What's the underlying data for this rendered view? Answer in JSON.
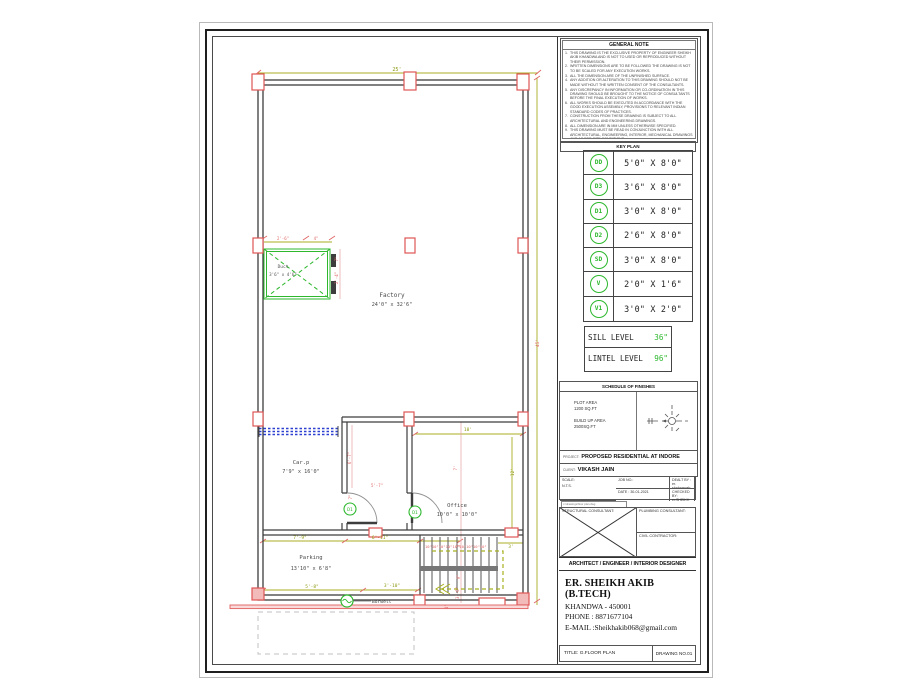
{
  "sheet": {
    "general_note": {
      "title": "GENERAL NOTE",
      "items": [
        "THIS DRAWING IS THE EXCLUSIVE PROPERTY OF ENGINEER SHEIKH AKIB KHANDWA AND IS NOT TO USED OR REPRODUCED WITHOUT THEIR PERMISSION.",
        "WRITTEN DIMENSIONS ARE TO BE FOLLOWED THE DRAWING IS NOT TO BE SCALED FOR ANY EXECUTION WORKS.",
        "ALL THE DIMENSION ARE OF THE UNFINISHED SURFACE.",
        "ANY ADDITION OR ALTERATION TO THIS DRAWING SHOULD NOT BE MADE WITHOUT THE WRITTEN CONSENT OF THE CONSULTANTS.",
        "ANY DISCREPANCY IN INFORMATION OR CO-ORDINATION IN THIS DRAWING SHOULD BE BROUGHT TO THE NOTICE OF CONSULTANTS BEFORE THE FINAL EXECUTION OF WORKS.",
        "ALL WORKS SHOULD BE EXECUTED IN ACCORDANCE WITH THE GOOD EXECUTION ASSEMBLY, PROVISIONS TO RELEVANT INDIAN STANDARD CODES OF PRACTICES.",
        "CONSTRUCTION FROM THESE DRAWING IS SUBJECT TO ALL ARCHITECTURAL AND ENGINEERING DRAWINGS.",
        "ALL DIMENSION ARE IN MM UNLESS OTHERWISE SPECIFIED.",
        "THIS DRAWING MUST BE READ IN CONJUNCTION WITH ALL ARCHITECTURAL, ENGINEERING, INTERIOR, MECHANICAL DRAWINGS AND AS PER SITE CONDITIONS."
      ]
    },
    "key_plan": {
      "title": "KEY PLAN",
      "rows": [
        {
          "code": "DD",
          "size": "5'0\" X 8'0\""
        },
        {
          "code": "D3",
          "size": "3'6\" X 8'0\""
        },
        {
          "code": "D1",
          "size": "3'0\" X 8'0\""
        },
        {
          "code": "D2",
          "size": "2'6\" X 8'0\""
        },
        {
          "code": "SD",
          "size": "3'0\" X 8'0\""
        },
        {
          "code": "V",
          "size": "2'0\" X 1'6\""
        },
        {
          "code": "V1",
          "size": "3'0\" X 2'0\""
        }
      ]
    },
    "levels": {
      "sill_label": "SILL LEVEL",
      "sill_value": "36\"",
      "lintel_label": "LINTEL LEVEL",
      "lintel_value": "96\""
    },
    "finishes": {
      "title": "SCHEDULE OF FINISHES",
      "plot_area_label": "PLOT AREA",
      "plot_area_value": "1200 SQ.FT",
      "builtup_label": "BUILD UP AREA",
      "builtup_value": "2500SQ.FT"
    },
    "project": {
      "label": "PROJECT:",
      "value": "PROPOSED RESIDENTIAL AT INDORE"
    },
    "client": {
      "label": "CLIENT:",
      "value": "VIKASH JAIN"
    },
    "meta": {
      "job_no": "JOB NO.:",
      "dealt_by": "DEALT BY : er. shahnawab",
      "scale_label": "SCALE:",
      "scale_value": "N.T.S.",
      "date": "DATE :   30-01-2021",
      "checked_by": "CHECKED BY: er.SHEIKH AKIB",
      "file_path_note": "c:\\drawings\\floor plan.dwg"
    },
    "consultants": {
      "structural": "STRUCTURAL CONSULTANT:",
      "plumbing": "PLUMBING CONSULTANT:",
      "civil": "CIVIL CONTRACTOR:"
    },
    "designer_bar": "ARCHITECT / ENGINEER / INTERIOR DESIGNER",
    "contact": {
      "name": "ER. SHEIKH AKIB (B.TECH)",
      "address": "KHANDWA - 450001",
      "phone": "PHONE : 8871677104",
      "email": "E-MAIL :Sheikhakib068@gmail.com"
    },
    "title_bar": {
      "title": "TITLE: G.FLOOR PLAN",
      "drawing_no": "DRAWING NO.01"
    }
  },
  "plan": {
    "rooms": {
      "factory": {
        "name": "Factory",
        "size": "24'0\" x 32'6\""
      },
      "carp": {
        "name": "Car.p",
        "size": "7'9\" x 16'0\""
      },
      "office": {
        "name": "Office",
        "size": "10'0\" x 10'0\""
      },
      "parking": {
        "name": "Parking",
        "size": "13'10\" x 6'8\""
      },
      "duct": {
        "name": "Duct",
        "size": "3'6\" x 4'6\""
      }
    },
    "door_label": "D1",
    "borwell_label": "Borwell",
    "dims": {
      "top_width": "25'",
      "right_height": "45'",
      "office_width": "10'",
      "office_height": "12'",
      "dim_7_9": "7'-9\"",
      "dim_6_11": "6'-11\"",
      "dim_5_8": "5'-8\"",
      "dim_3_10": "3'-10\"",
      "dim_5_7": "5'-7\"",
      "dim_6_7": "6'-7\"",
      "dim_7a": "7\"",
      "dim_7ft": "7'",
      "dim_3ft": "3'",
      "dim_9in": "9\"",
      "dim_3_6": "3'-6\"",
      "dim_4ft": "4'",
      "duct_2_6": "2'-6\"",
      "duct_4": "4\"",
      "duct_7": "7\"",
      "duct_2_4": "2'-4\"",
      "stair_treads": "10\"10\"10\"10\"10\"10\"10\"10\"10\"",
      "stair_landing": "3'"
    }
  },
  "colors": {
    "accent_green": "#2db82d",
    "dim_olive": "#9aa31a",
    "dim_red": "#e06666",
    "wall_gray": "#3d3d3d",
    "column_red": "#e05555",
    "gate_blue": "#2b3fd0"
  }
}
